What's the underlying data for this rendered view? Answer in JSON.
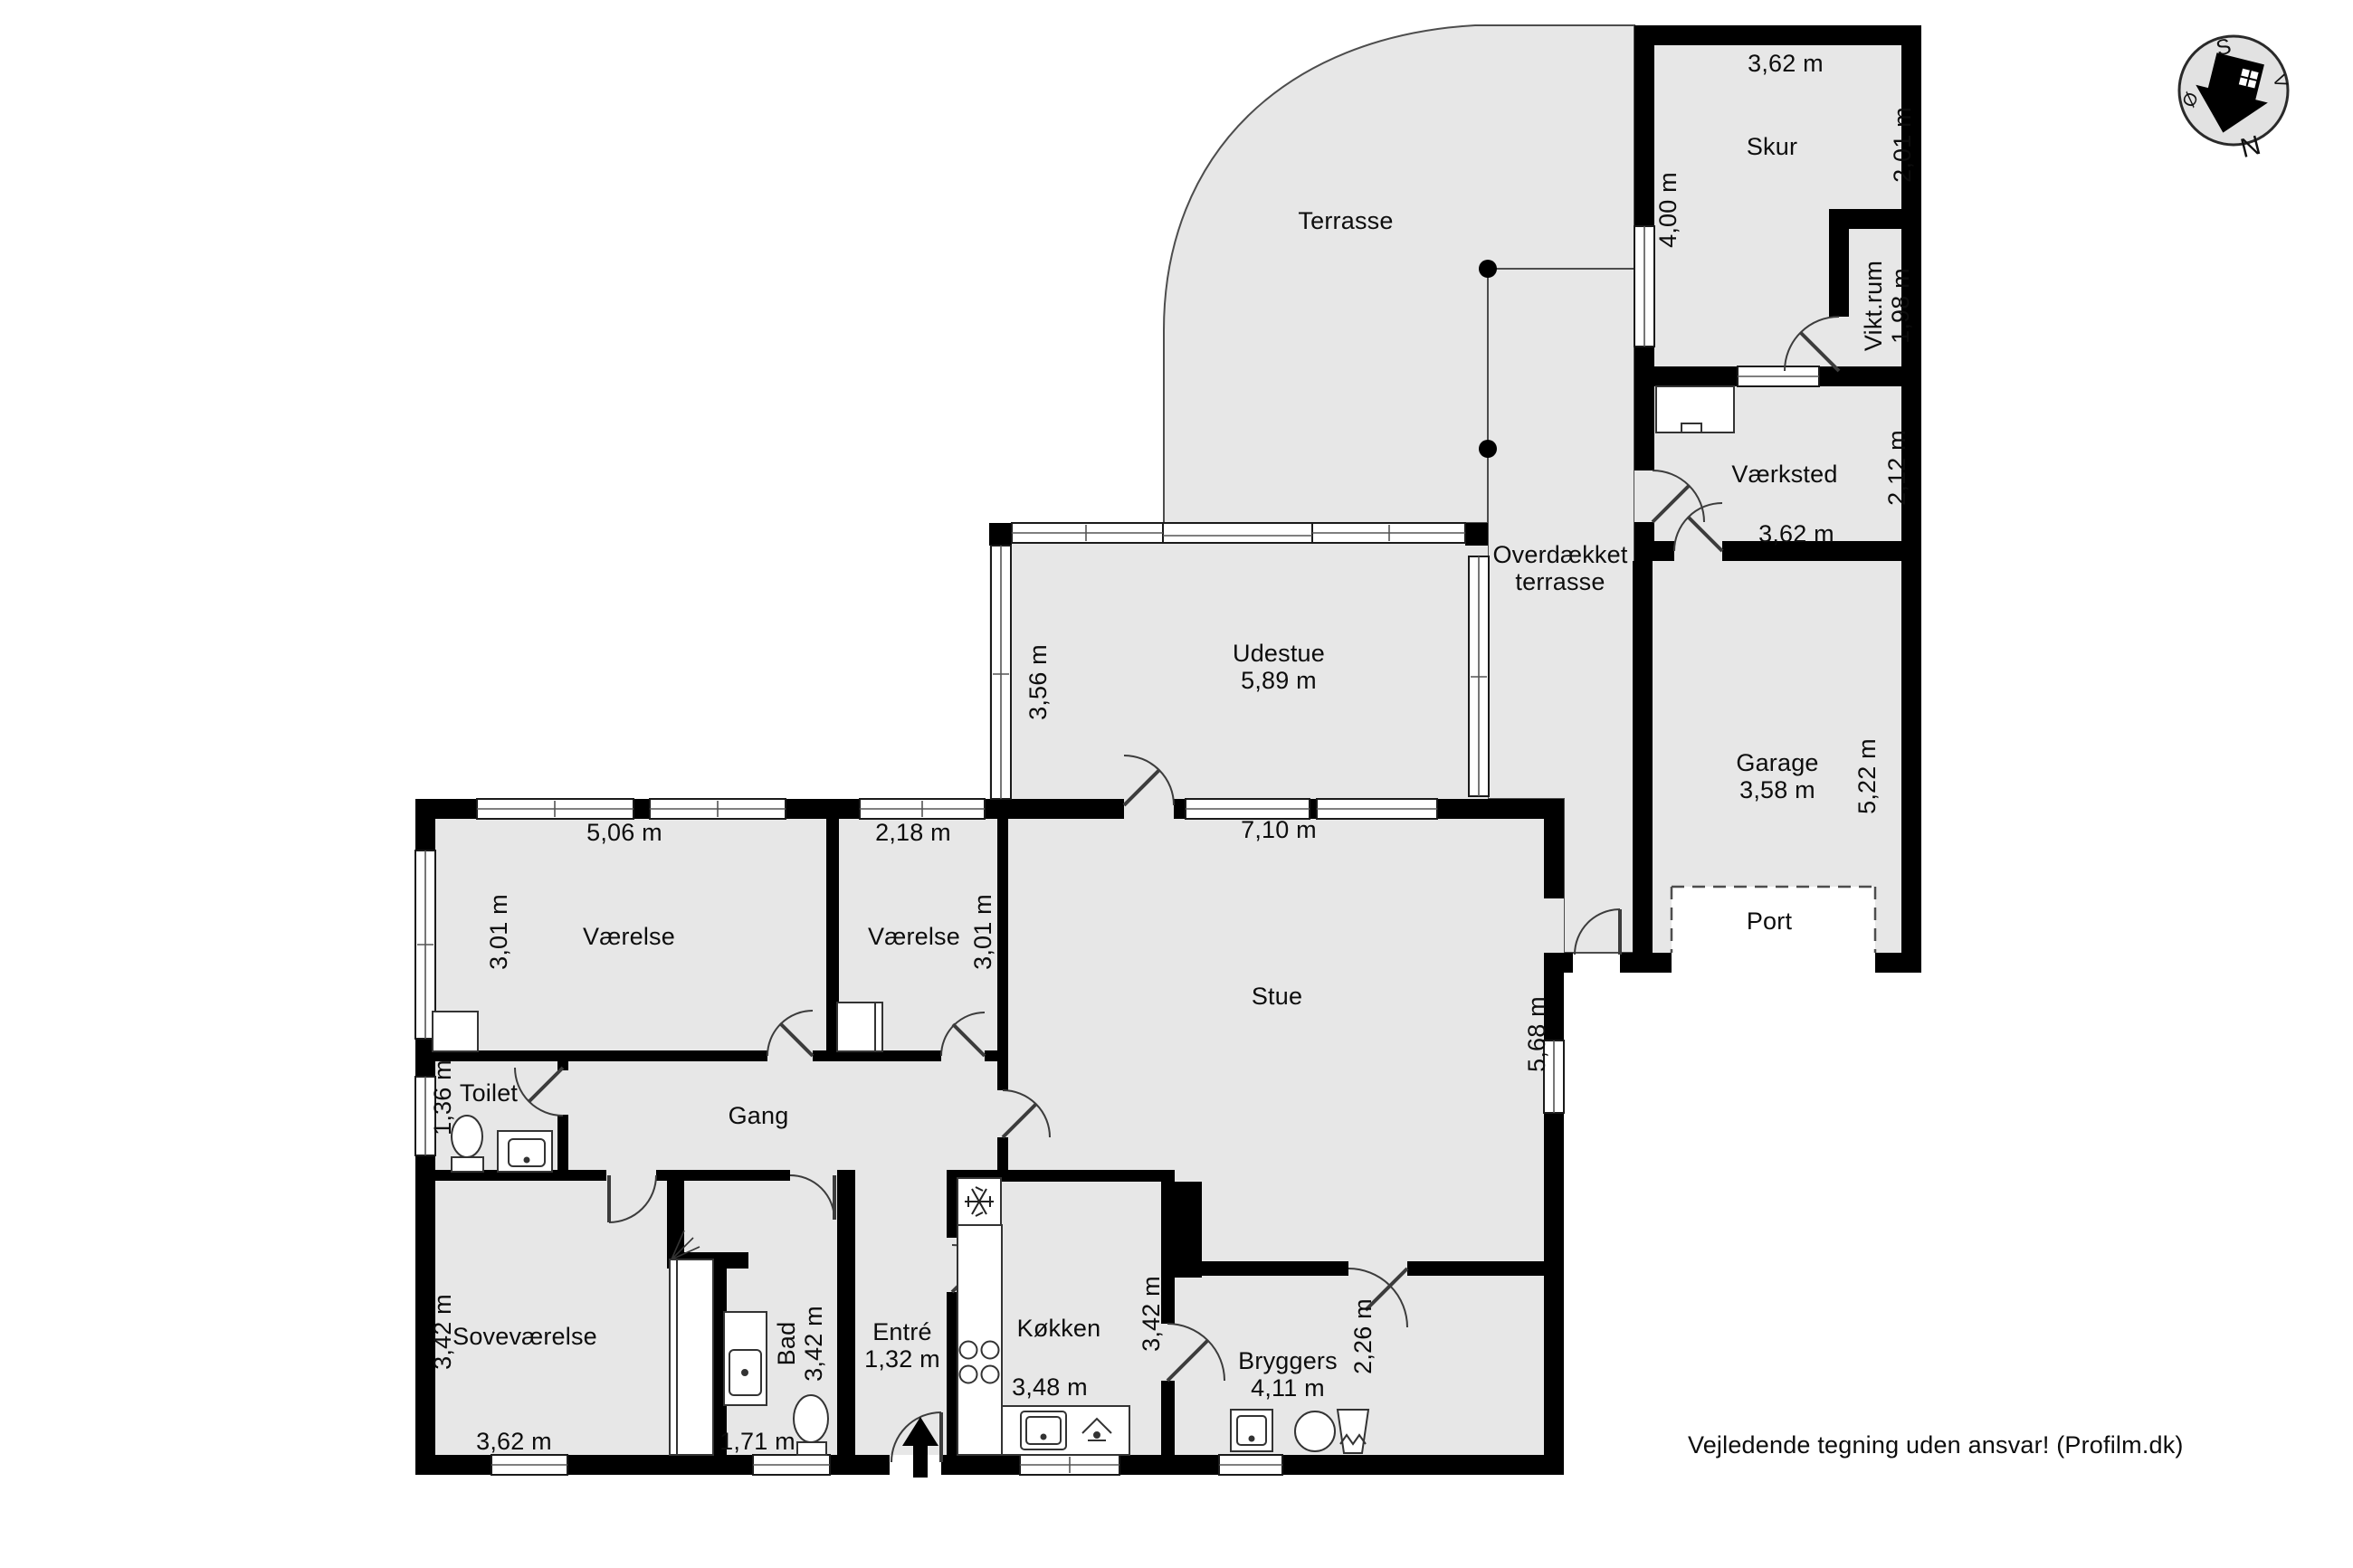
{
  "drawing": {
    "type": "floorplan",
    "colors": {
      "floor": "#e7e7e7",
      "wall": "#000000",
      "outline": "#4d4d4d",
      "fixture_stroke": "#333333"
    },
    "disclaimer": "Vejledende tegning uden ansvar! (Profilm.dk)"
  },
  "compass": {
    "s": "S",
    "v": "V",
    "n": "N",
    "oe": "Ø"
  },
  "labels": {
    "terrasse": "Terrasse",
    "skur": "Skur",
    "skur_top_dim": "3,62 m",
    "skur_right_dim": "2,01 m",
    "skur_wall_dim": "4,00 m",
    "viktrum": "Vikt.rum\n1,98 m",
    "vaerksted": "Værksted",
    "vaerksted_right_dim": "2,12 m",
    "vaerksted_bottom_dim": "3,62 m",
    "overdaekket": "Overdækket\nterrasse",
    "garage": "Garage\n3,58 m",
    "garage_right_dim": "5,22 m",
    "port": "Port",
    "udestue": "Udestue\n5,89 m",
    "udestue_left_dim": "3,56 m",
    "stue_top_dim": "7,10 m",
    "v1_top_dim": "5,06 m",
    "v2_top_dim": "2,18 m",
    "v1_left_dim": "3,01 m",
    "v2_right_dim": "3,01 m",
    "v1": "Værelse",
    "v2": "Værelse",
    "stue": "Stue",
    "stue_right_dim": "5,68 m",
    "toilet": "Toilet",
    "toilet_left_dim": "1,36 m",
    "gang": "Gang",
    "sove": "Soveværelse",
    "sove_left_dim": "3,42 m",
    "sove_bottom_dim": "3,62 m",
    "bad": "Bad\n3,42 m",
    "bad_bottom_dim": "1,71 m",
    "entre": "Entré\n1,32 m",
    "koekken": "Køkken",
    "koekken_bottom_dim": "3,48 m",
    "koekken_right_dim": "3,42 m",
    "bryggers": "Bryggers\n4,11 m",
    "bryggers_right_dim": "2,26 m",
    "disclaimer": "Vejledende tegning uden ansvar! (Profilm.dk)"
  }
}
